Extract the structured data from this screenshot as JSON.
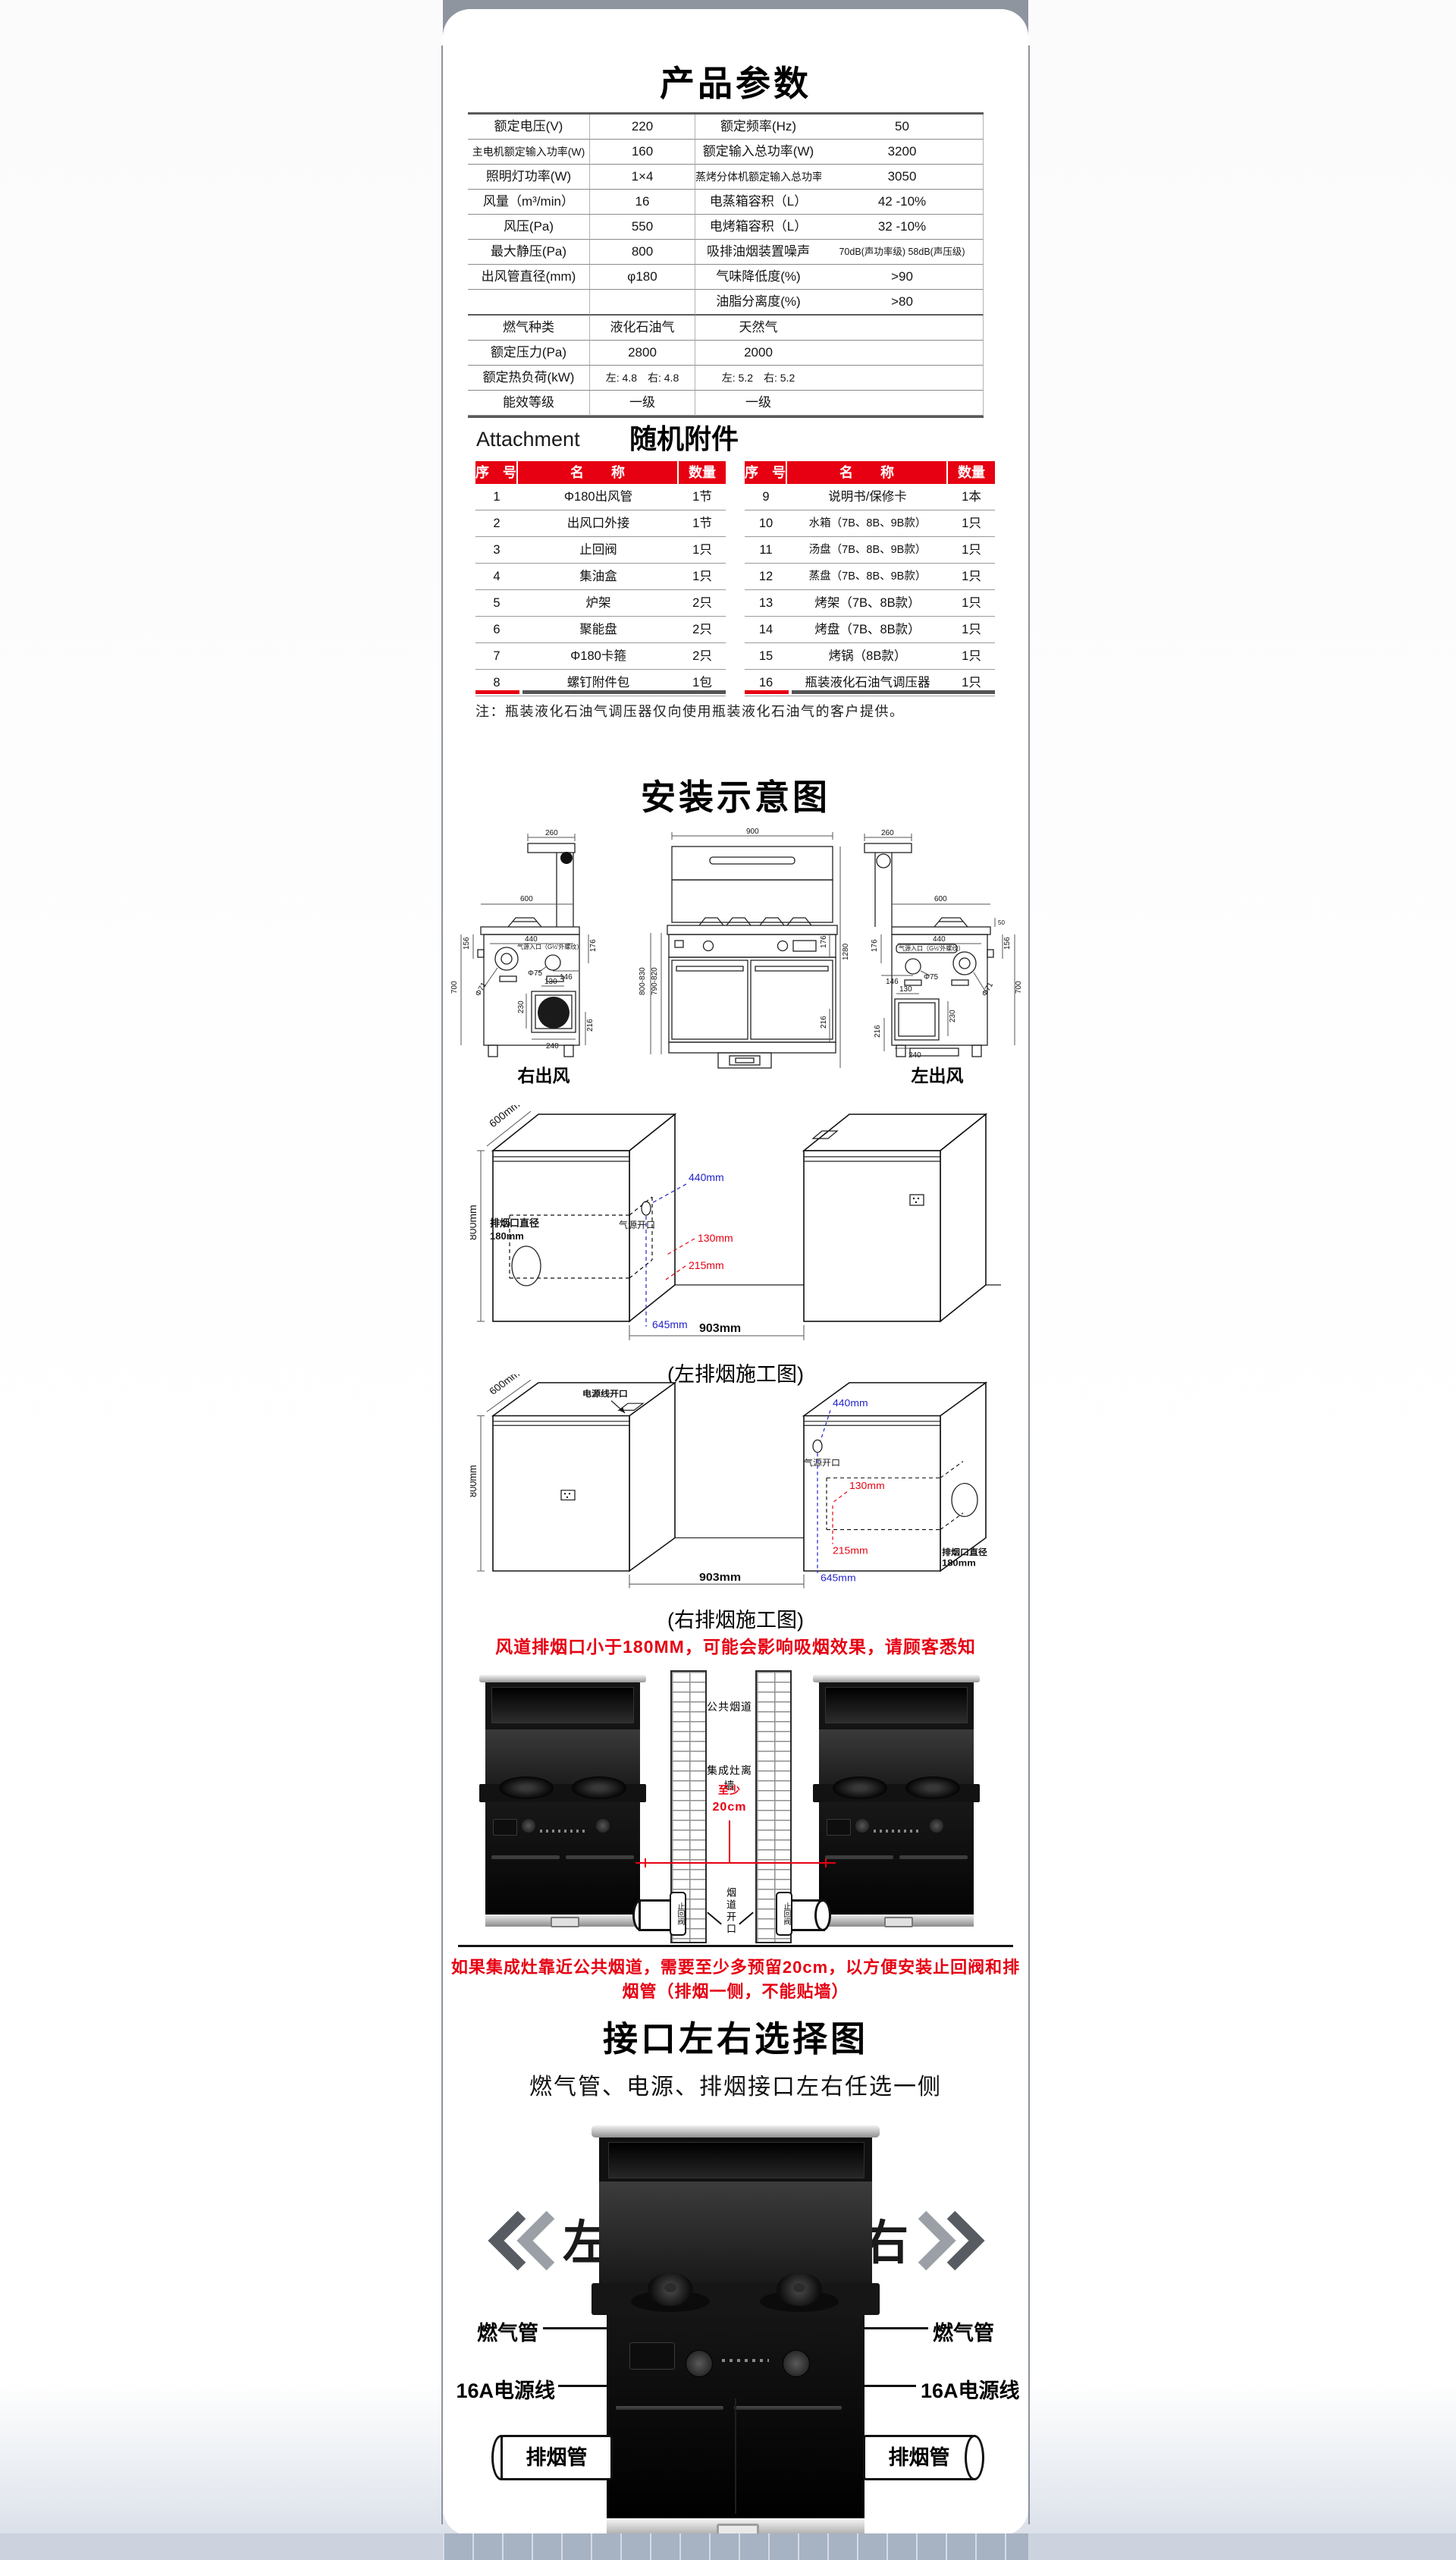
{
  "colors": {
    "accent_red": "#e60012",
    "dim_blue": "#2222cc",
    "top_band_gray": "#8e959e",
    "bottom_band": "#a7b2c3"
  },
  "product_params": {
    "title": "产品参数",
    "rows": [
      [
        "额定电压(V)",
        "220",
        "额定频率(Hz)",
        "50"
      ],
      [
        "主电机额定输入功率(W)",
        "160",
        "额定输入总功率(W)",
        "3200"
      ],
      [
        "照明灯功率(W)",
        "1×4",
        "蒸烤分体机额定输入总功率(W)",
        "3050"
      ],
      [
        "风量（m³/min）",
        "16",
        "电蒸箱容积（L）",
        "42 -10%"
      ],
      [
        "风压(Pa)",
        "550",
        "电烤箱容积（L）",
        "32 -10%"
      ],
      [
        "最大静压(Pa)",
        "800",
        "吸排油烟装置噪声",
        "70dB(声功率级) 58dB(声压级)"
      ],
      [
        "出风管直径(mm)",
        "φ180",
        "气味降低度(%)",
        ">90"
      ],
      [
        "",
        "",
        "油脂分离度(%)",
        ">80"
      ],
      [
        "燃气种类",
        "液化石油气",
        "天然气",
        ""
      ],
      [
        "额定压力(Pa)",
        "2800",
        "2000",
        ""
      ],
      [
        "额定热负荷(kW)",
        "左: 4.8　右: 4.8",
        "左: 5.2　右: 5.2",
        ""
      ],
      [
        "能效等级",
        "一级",
        "一级",
        ""
      ]
    ]
  },
  "attachments": {
    "title_en": "Attachment",
    "title_cn": "随机附件",
    "headers": [
      "序　号",
      "名　　称",
      "数量"
    ],
    "left_rows": [
      [
        "1",
        "Φ180出风管",
        "1节"
      ],
      [
        "2",
        "出风口外接",
        "1节"
      ],
      [
        "3",
        "止回阀",
        "1只"
      ],
      [
        "4",
        "集油盒",
        "1只"
      ],
      [
        "5",
        "炉架",
        "2只"
      ],
      [
        "6",
        "聚能盘",
        "2只"
      ],
      [
        "7",
        "Φ180卡箍",
        "2只"
      ],
      [
        "8",
        "螺钉附件包",
        "1包"
      ]
    ],
    "right_rows": [
      [
        "9",
        "说明书/保修卡",
        "1本"
      ],
      [
        "10",
        "水箱（7B、8B、9B款）",
        "1只"
      ],
      [
        "11",
        "汤盘（7B、8B、9B款）",
        "1只"
      ],
      [
        "12",
        "蒸盘（7B、8B、9B款）",
        "1只"
      ],
      [
        "13",
        "烤架（7B、8B款）",
        "1只"
      ],
      [
        "14",
        "烤盘（7B、8B款）",
        "1只"
      ],
      [
        "15",
        "烤锅（8B款）",
        "1只"
      ],
      [
        "16",
        "瓶装液化石油气调压器",
        "1只"
      ]
    ],
    "note": "注：瓶装液化石油气调压器仅向使用瓶装液化石油气的客户提供。"
  },
  "install": {
    "title": "安装示意图",
    "caption_right_outlet": "右出风",
    "caption_left_outlet": "左出风",
    "dims": {
      "d260": "260",
      "d600": "600",
      "d900": "900",
      "d1280": "1280",
      "d50": "50",
      "d156": "156",
      "d176": "176",
      "d146": "146",
      "d440": "440",
      "d130": "130",
      "d230": "230",
      "d240": "240",
      "d216": "216",
      "d700": "700",
      "range_a": "800-830",
      "range_b": "790-820",
      "phi71": "Φ71",
      "phi75": "Φ75",
      "gas_inlet": "气源入口（G½'外螺纹）"
    },
    "duct": {
      "caption_left": "(左排烟施工图)",
      "caption_right": "(右排烟施工图)",
      "depth": "600mm",
      "height": "800mm",
      "blue_top": "440mm",
      "red_h": "130mm",
      "red_v": "215mm",
      "blue_bottom": "645mm",
      "span": "903mm",
      "outlet_line1": "排烟口直径",
      "outlet_line2": "180mm",
      "gas_opening": "气源开口",
      "power_opening": "电源线开口",
      "warning": "风道排烟口小于180MM，可能会影响吸烟效果，请顾客悉知"
    },
    "flue": {
      "public_flue": "公共烟道",
      "wall_black": "集成灶离墙",
      "wall_red_a": "至少",
      "wall_red_b": "20cm",
      "opening": "烟道开口",
      "check_valve": "止回阀",
      "warning": "如果集成灶靠近公共烟道，需要至少多预留20cm，以方便安装止回阀和排烟管（排烟一侧，不能贴墙）"
    }
  },
  "interface": {
    "title": "接口左右选择图",
    "subtitle": "燃气管、电源、排烟接口左右任选一侧",
    "left": "左",
    "right": "右",
    "gas": "燃气管",
    "power": "16A电源线",
    "exhaust": "排烟管"
  }
}
